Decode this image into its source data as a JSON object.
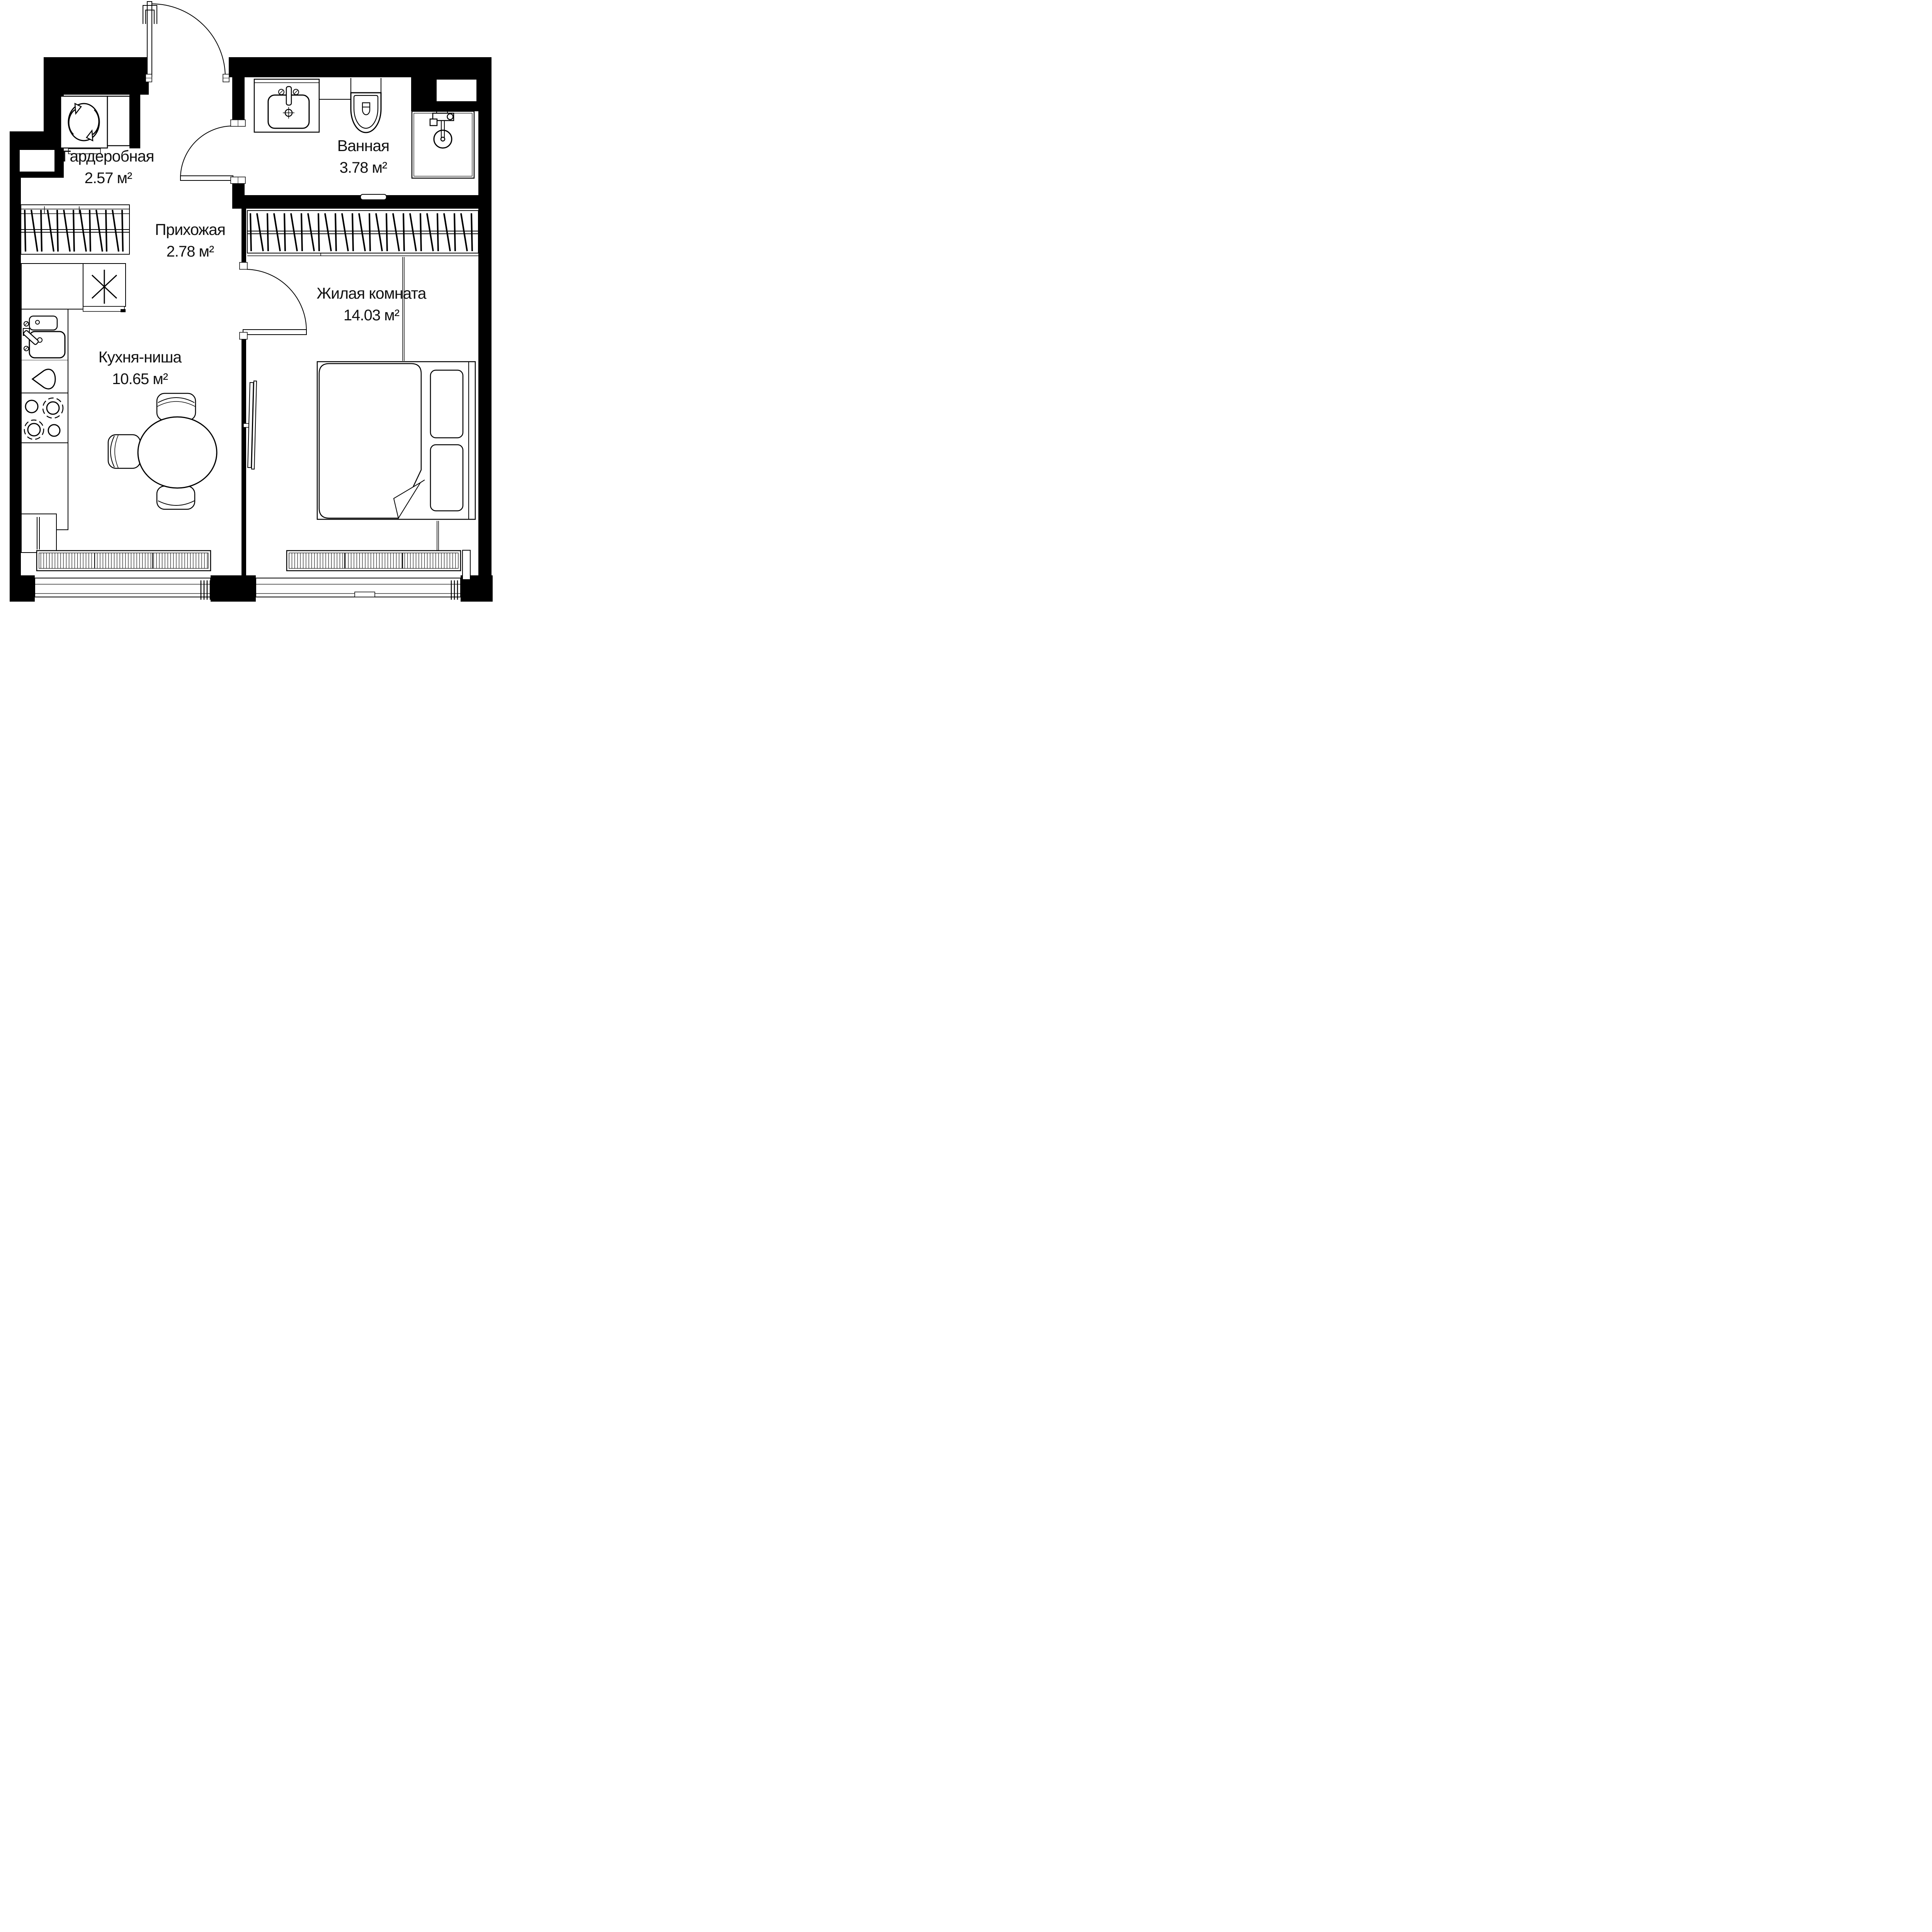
{
  "plan": {
    "type": "apartment-floor-plan",
    "rooms": [
      {
        "id": "wardrobe",
        "name": "Гардеробная",
        "area": "2.57 м²"
      },
      {
        "id": "hallway",
        "name": "Прихожая",
        "area": "2.78 м²"
      },
      {
        "id": "bathroom",
        "name": "Ванная",
        "area": "3.78 м²"
      },
      {
        "id": "living",
        "name": "Жилая комната",
        "area": "14.03 м²"
      },
      {
        "id": "kitchen",
        "name": "Кухня-ниша",
        "area": "10.65 м²"
      }
    ],
    "colors": {
      "wall": "#000000",
      "background": "#ffffff",
      "line": "#000000"
    },
    "icons": {
      "washing-machine-icon": "circular-arrows",
      "asterisk-icon": "six-ray-star",
      "stove-icon": "four-burners",
      "toilet-icon": "wall-hung-wc",
      "shower-icon": "shower-head",
      "sink-icon": "basin-with-faucet",
      "kitchen-sink-icon": "double-bowl-sink",
      "teardrop-icon": "drop",
      "clothes-rack": "hanger-hatching",
      "radiator": "striped-convector"
    }
  }
}
